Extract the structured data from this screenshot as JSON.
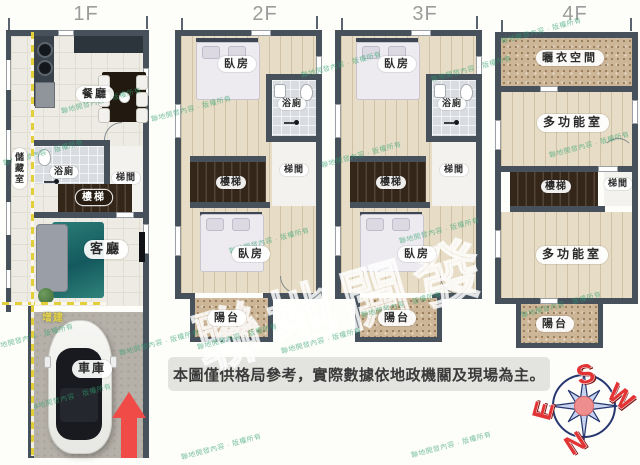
{
  "colors": {
    "wall": "#46515c",
    "arrow_red": "#f04b46",
    "dash_yellow": "#e3cf3a",
    "watermark_green": "#2fa06e",
    "compass_letter_red": "#e23434",
    "disclaimer_bg": "#e3e3e0"
  },
  "floors": {
    "f1": {
      "title": "1F",
      "storage": "儲藏室",
      "dining": "餐廳",
      "bath": "浴廁",
      "stairs": "樓梯",
      "stairhall": "梯間",
      "living": "客廳",
      "garage": "車庫",
      "annex_note": "增建"
    },
    "f2": {
      "title": "2F",
      "bed_top": "臥房",
      "bath": "浴廁",
      "stairs": "樓梯",
      "stairhall": "梯間",
      "bed_bottom": "臥房",
      "balcony": "陽台"
    },
    "f3": {
      "title": "3F",
      "bed_top": "臥房",
      "bath": "浴廁",
      "stairs": "樓梯",
      "stairhall": "梯間",
      "bed_bottom": "臥房",
      "balcony": "陽台"
    },
    "f4": {
      "title": "4F",
      "drying": "曬衣空間",
      "multi_top": "多功能室",
      "stairs": "樓梯",
      "stairhall": "梯間",
      "multi_bottom": "多功能室",
      "balcony": "陽台"
    }
  },
  "disclaimer": "本圖僅供格局參考，實際數據依地政機關及現場為主。",
  "compass": {
    "top": "S",
    "right": "W",
    "bottom": "N",
    "left": "E"
  },
  "watermark": {
    "big": "聯地開發",
    "small": "聯地開發內容 · 版權所有"
  }
}
